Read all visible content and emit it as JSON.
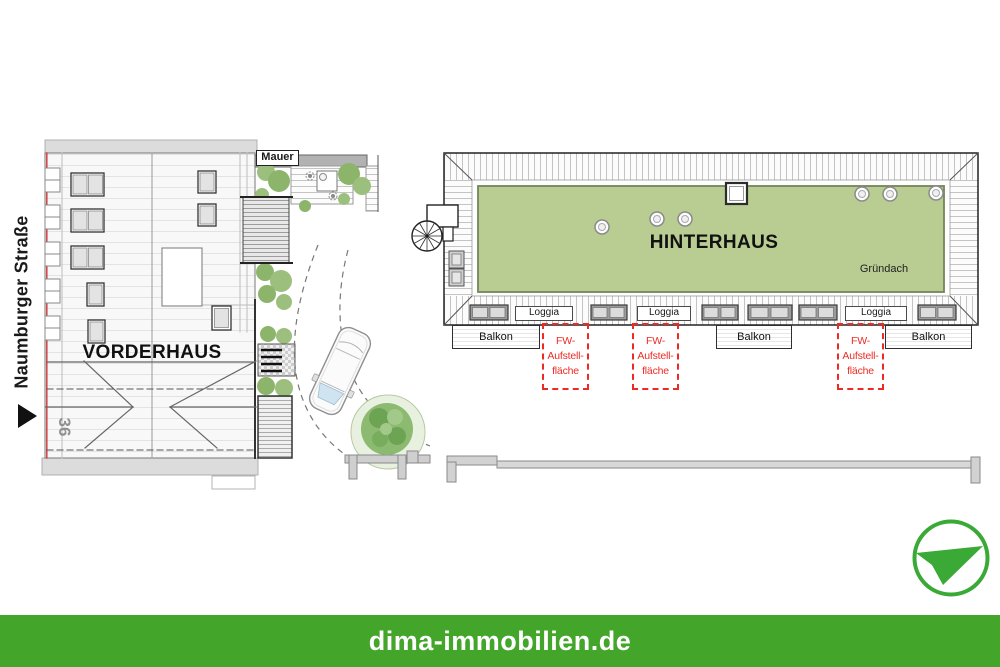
{
  "site_plan": {
    "street": {
      "name": "Naumburger Straße"
    },
    "house_number": "36",
    "front_house_label": "VORDERHAUS",
    "back_house_label": "HINTERHAUS",
    "green_roof_label": "Gründach",
    "wall_label": "Mauer",
    "loggias": [
      "Loggia",
      "Loggia",
      "Loggia"
    ],
    "balconies": [
      "Balkon",
      "Balkon",
      "Balkon"
    ],
    "fire_lanes": [
      {
        "line1": "FW-",
        "line2": "Aufstell-",
        "line3": "fläche"
      },
      {
        "line1": "FW-",
        "line2": "Aufstell-",
        "line3": "fläche"
      },
      {
        "line1": "FW-",
        "line2": "Aufstell-",
        "line3": "fläche"
      }
    ]
  },
  "footer": {
    "website": "dima-immobilien.de"
  },
  "branding": {
    "logo": "paper-plane-logo",
    "footer_green": "#43a62a",
    "logo_green": "#3aa935"
  },
  "colors": {
    "green_roof": "#b9cd92",
    "fire_lane_red": "#ed2b24",
    "facade_line_red": "#d34b4b"
  }
}
